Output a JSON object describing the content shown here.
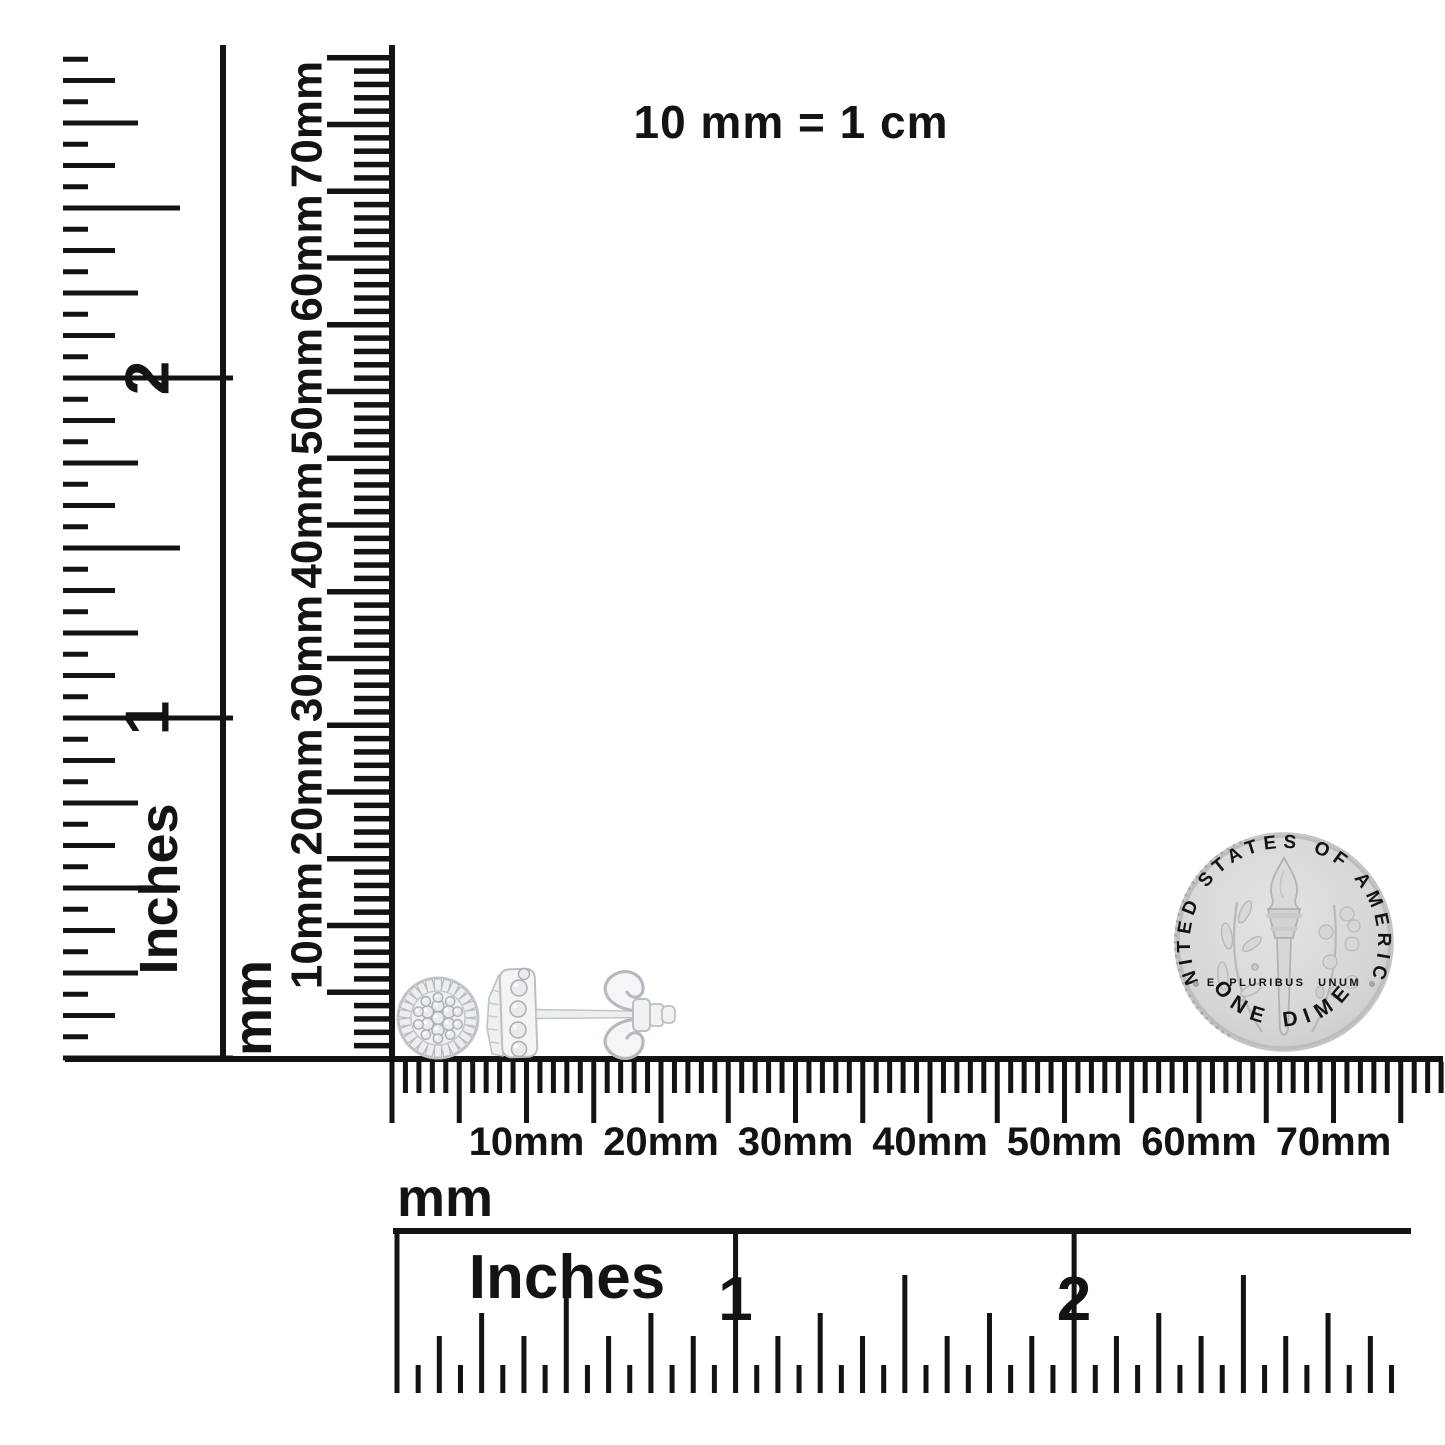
{
  "header": {
    "scale_note": "10 mm = 1 cm"
  },
  "colors": {
    "ink": "#131313",
    "background": "#ffffff",
    "metal_stroke": "#b4bac0",
    "metal_fill": "#f3f4f6",
    "gem_stroke": "#a9b0b6",
    "gem_fill": "#e8eaec",
    "coin_body": "#d5d6d6",
    "coin_rim": "#bcbdbd",
    "coin_detail": "#b3b3b3",
    "coin_text": "#9c9c9c"
  },
  "rulers": {
    "left_inch": {
      "name": "left-inch-ruler",
      "unit_label": "Inches",
      "numbers": [
        {
          "text": "2",
          "inch": 2
        },
        {
          "text": "1",
          "inch": 1
        }
      ],
      "geometry": {
        "axis": "v",
        "spine": {
          "pos": 223,
          "from": 45,
          "to": 1061,
          "w": 6
        },
        "origin": 1058,
        "dir": -1,
        "step": 21.25,
        "count": 47,
        "unit_px": 340,
        "anchor": 63,
        "grow": 1,
        "tick_w": 5,
        "levels": [
          {
            "every": 16,
            "len": 170
          },
          {
            "every": 8,
            "len": 117
          },
          {
            "every": 4,
            "len": 75
          },
          {
            "every": 2,
            "len": 52
          },
          {
            "every": 1,
            "len": 25
          }
        ],
        "number_style": {
          "pos": 147,
          "size": 62,
          "rotate": true
        },
        "unit_label_style": {
          "x": 158,
          "y": 889,
          "size": 54,
          "rotate": true
        }
      }
    },
    "left_mm": {
      "name": "left-mm-ruler",
      "unit_label": "mm",
      "labels": [
        {
          "text": "70mm",
          "mm": 70
        },
        {
          "text": "60mm",
          "mm": 60
        },
        {
          "text": "50mm",
          "mm": 50
        },
        {
          "text": "40mm",
          "mm": 40
        },
        {
          "text": "30mm",
          "mm": 30
        },
        {
          "text": "20mm",
          "mm": 20
        },
        {
          "text": "10mm",
          "mm": 10
        }
      ],
      "geometry": {
        "axis": "v",
        "spine": {
          "pos": 392,
          "from": 45,
          "to": 1062,
          "w": 6
        },
        "origin": 1059,
        "dir": -1,
        "step": 13.35,
        "count": 75,
        "unit_px": 13.35,
        "anchor": 390,
        "grow": -1,
        "tick_w": 5.5,
        "levels": [
          {
            "every": 5,
            "len": 63
          },
          {
            "every": 1,
            "len": 36
          }
        ],
        "label_style": {
          "pos": 306,
          "size": 44,
          "rotate": true
        },
        "unit_label_style": {
          "x": 252,
          "y": 1008,
          "size": 54,
          "rotate": true
        }
      }
    },
    "bottom_mm": {
      "name": "bottom-mm-ruler",
      "unit_label": "mm",
      "labels": [
        {
          "text": "10mm",
          "mm": 10
        },
        {
          "text": "20mm",
          "mm": 20
        },
        {
          "text": "30mm",
          "mm": 30
        },
        {
          "text": "40mm",
          "mm": 40
        },
        {
          "text": "50mm",
          "mm": 50
        },
        {
          "text": "60mm",
          "mm": 60
        },
        {
          "text": "70mm",
          "mm": 70
        }
      ],
      "geometry": {
        "axis": "h",
        "spine": {
          "pos": 1059,
          "from": 65,
          "to": 1443,
          "w": 6
        },
        "origin": 392,
        "dir": 1,
        "step": 13.45,
        "count": 78,
        "unit_px": 13.45,
        "anchor": 1062,
        "grow": 1,
        "tick_w": 5,
        "levels": [
          {
            "every": 5,
            "len": 61
          },
          {
            "every": 1,
            "len": 31
          }
        ],
        "label_style": {
          "pos": 1155,
          "size": 40
        },
        "unit_label_style": {
          "x": 445,
          "y": 1216,
          "size": 54
        }
      }
    },
    "bottom_inch": {
      "name": "bottom-inch-ruler",
      "unit_label": "Inches",
      "numbers": [
        {
          "text": "1",
          "inch": 1
        },
        {
          "text": "2",
          "inch": 2
        }
      ],
      "geometry": {
        "axis": "h",
        "spine": {
          "pos": 1231,
          "from": 393,
          "to": 1411,
          "w": 6
        },
        "origin": 397,
        "dir": 1,
        "step": 21.16,
        "count": 47,
        "unit_px": 338.5,
        "anchor": 1393,
        "grow": -1,
        "tick_w": 5,
        "levels": [
          {
            "every": 16,
            "len": 162
          },
          {
            "every": 8,
            "len": 118
          },
          {
            "every": 4,
            "len": 80
          },
          {
            "every": 2,
            "len": 57
          },
          {
            "every": 1,
            "len": 28
          }
        ],
        "number_style": {
          "pos": 1320,
          "size": 62
        },
        "unit_label_style": {
          "x": 567,
          "y": 1298,
          "size": 62
        }
      }
    }
  },
  "coin": {
    "top_text": "UNITED STATES OF AMERICA",
    "motto_text": "E PLURIBUS UNUM",
    "bottom_text": "ONE DIME"
  }
}
